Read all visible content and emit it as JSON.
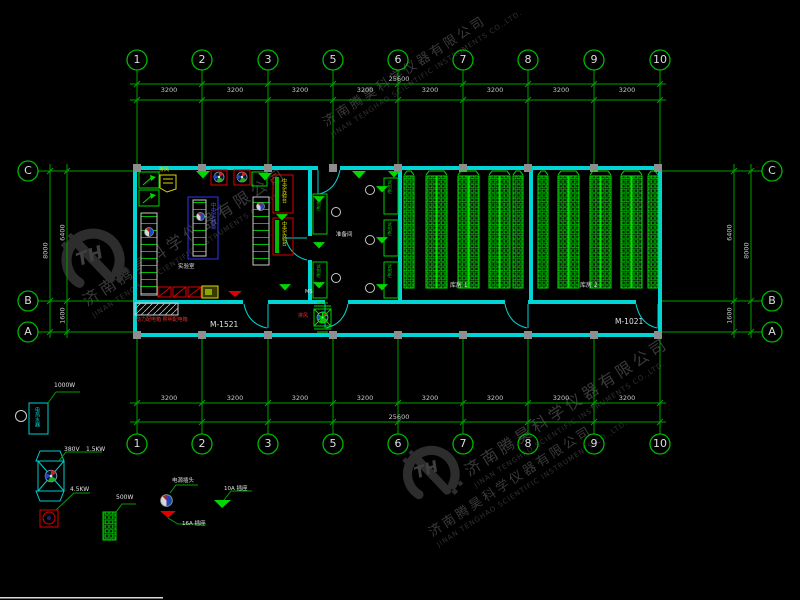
{
  "watermark": {
    "company_cn": "济南腾昊科学仪器有限公司",
    "company_en": "JINAN TENGHAO SCIENTIFIC INSTRUMENTS CO.,LTD.",
    "logo_text": "TH"
  },
  "grid": {
    "top_columns": [
      "1",
      "2",
      "3",
      "5",
      "6",
      "7",
      "8",
      "9",
      "10"
    ],
    "row_labels": [
      "C",
      "B",
      "A"
    ],
    "span_dim": "3200",
    "total_dim": "25600",
    "side_total_dim": "8000",
    "side_upper_dim": "6400",
    "side_lower_dim": "1600"
  },
  "plan": {
    "door_left_label": "M-1521",
    "door_right_label": "M-1021",
    "room_lab_label": "实验室",
    "room_mid_label": "准备间",
    "room_store1_label": "库房 1",
    "room_store2_label": "库房 2",
    "bench_label": "中央实验台",
    "cabinet_label": "试剂柜",
    "fume_hood_label": "排风",
    "corridor_fan_label": "排风",
    "panel_label": "动力配电箱 照明配电箱",
    "ms_label": "MS"
  },
  "legend": {
    "water_heater_text": "电热水器",
    "water_heater_power": "1000W",
    "fan_voltage": "380V",
    "fan_power": "1.5KW",
    "exhaust_fan_power": "4.5KW",
    "rack_power": "500W",
    "plug_label": "电源插头",
    "socket16_label": "16A 插座",
    "socket10_label": "10A 插座"
  }
}
